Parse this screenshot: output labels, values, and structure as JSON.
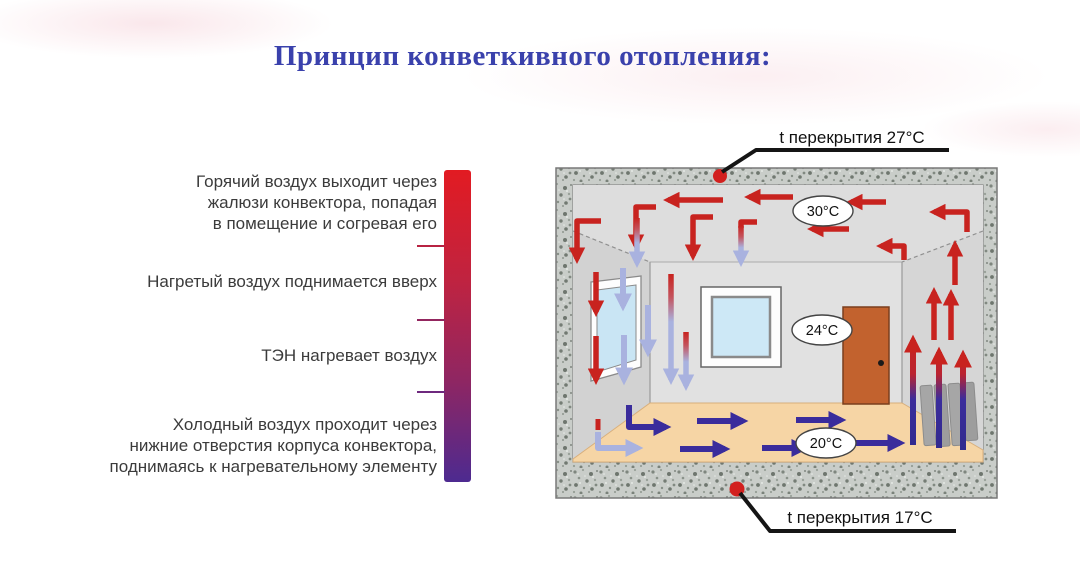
{
  "title": "Принцип конветкивного отопления:",
  "legend": {
    "items": [
      {
        "text": "Горячий воздух выходит через\nжалюзи конвектора, попадая\nв помещение и согревая его"
      },
      {
        "text": "Нагретый воздух поднимается вверх"
      },
      {
        "text": "ТЭН нагревает воздух"
      },
      {
        "text": "Холодный воздух проходит через\nнижние отверстия корпуса конвектора,\nподнимаясь к нагревательному элементу"
      }
    ]
  },
  "diagram": {
    "ceiling_callout": "t перекрытия 27°C",
    "floor_callout": "t перекрытия 17°C",
    "temperatures": {
      "upper": "30°C",
      "middle": "24°C",
      "lower": "20°C"
    }
  },
  "colors": {
    "title": "#3A41AC",
    "hot_air": "#C8231F",
    "cold_air_dark": "#3A2C9C",
    "cold_air_light": "#A9B2DF",
    "gradient_bar_top": "#E21B22",
    "gradient_bar_bottom": "#4D2A90"
  }
}
